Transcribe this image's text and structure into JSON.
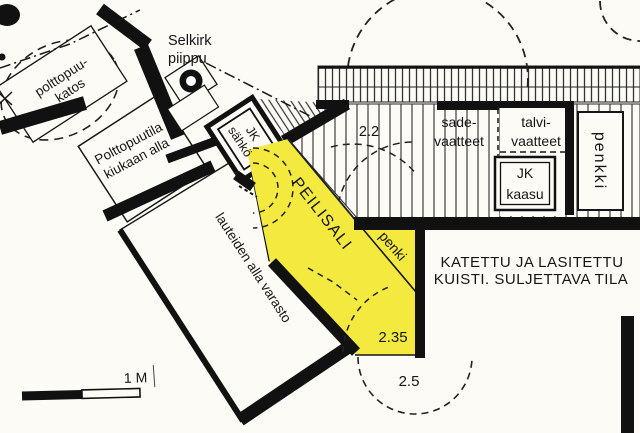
{
  "colors": {
    "highlight": "#f3e93f",
    "ink": "#161616",
    "paper": "#fcfbf6"
  },
  "labels": {
    "chimney": {
      "line1": "Selkirk",
      "line2": "piippu"
    },
    "woodshed": {
      "line1": "polttopuu-",
      "line2": "katos"
    },
    "wood_storage": {
      "line1": "Polttopuutila",
      "line2": "kiukaan alla"
    },
    "jk_electric": {
      "line1": "JK",
      "line2": "sähkö"
    },
    "under_benches": {
      "text": "lauteiden alla varasto"
    },
    "mirror_hall": {
      "text": "PEILISALI"
    },
    "bench_inner": {
      "text": "penki"
    },
    "rain_clothes": {
      "line1": "sade-",
      "line2": "vaatteet"
    },
    "winter_clothes": {
      "line1": "talvi-",
      "line2": "vaatteet"
    },
    "jk_gas": {
      "line1": "JK",
      "line2": "kaasu"
    },
    "bench_right": {
      "text": "penkki"
    },
    "porch": {
      "line1": "KATETTU JA LASITETTU",
      "line2": "KUISTI. SULJETTAVA TILA"
    },
    "scale_bar": {
      "text": "1 M"
    }
  },
  "dimensions": {
    "deck_width": "2.2",
    "hall_width": "2.35",
    "door_swing": "2.5"
  }
}
